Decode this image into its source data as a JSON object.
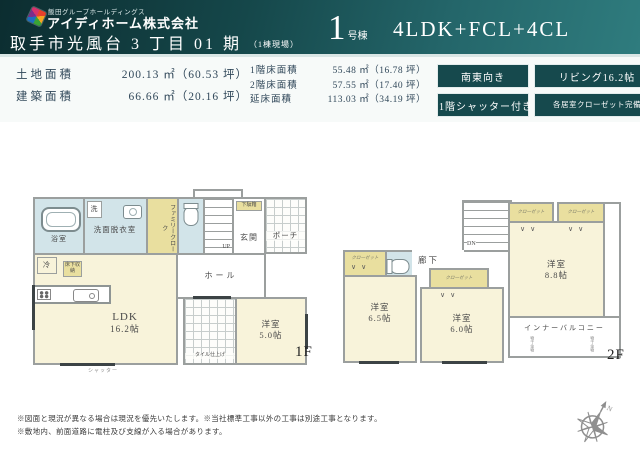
{
  "header": {
    "group_name": "飯田グループホールディングス",
    "company_name": "アイディホーム株式会社",
    "property_title": "取手市光風台 3 丁目 01 期",
    "property_note": "（1棟現場）",
    "unit_number": "1",
    "unit_suffix": "号棟",
    "layout_type": "4LDK+FCL+4CL"
  },
  "areas": {
    "left": [
      {
        "label": "土地面積",
        "value": "200.13 ㎡（60.53 坪）"
      },
      {
        "label": "建築面積",
        "value": "66.66 ㎡（20.16 坪）"
      }
    ],
    "right": [
      {
        "label": "1階床面積",
        "value": "55.48 ㎡（16.78 坪）"
      },
      {
        "label": "2階床面積",
        "value": "57.55 ㎡（17.40 坪）"
      },
      {
        "label": "延床面積",
        "value": "113.03 ㎡（34.19 坪）"
      }
    ]
  },
  "badges": [
    "南東向き",
    "リビング16.2帖",
    "1階シャッター付き",
    "各居室クローゼット完備"
  ],
  "colors": {
    "header_teal_dark": "#0c2d30",
    "header_teal_light": "#2f7c7e",
    "badge_bg": "#16494d",
    "room_tatami": "#f8f3da",
    "room_wet": "#d2e4e9",
    "room_closet": "#e9df9f",
    "wall_gray": "#9b9f9e"
  },
  "floor1": {
    "floor_label": "1F",
    "bath": "浴室",
    "washer": "洗",
    "washroom": "洗面脱衣室",
    "family_cloak": "ファミリークローク",
    "up": "UP",
    "shoe_box": "下駄箱",
    "entrance": "玄関",
    "porch": "ポーチ",
    "hall": "ホール",
    "fridge": "冷",
    "underfloor": "床下収納",
    "ldk": "LDK",
    "ldk_size": "16.2帖",
    "room_name": "洋室",
    "room_size": "5.0帖",
    "tile_note": "タイル仕上げ",
    "shutter_note": "シャッター"
  },
  "floor2": {
    "floor_label": "2F",
    "dn": "DN",
    "hallway": "廊下",
    "closet": "クローゼット",
    "room_a_name": "洋室",
    "room_a_size": "6.5帖",
    "room_b_name": "洋室",
    "room_b_size": "6.0帖",
    "room_c_name": "洋室",
    "room_c_size": "8.8帖",
    "balcony": "インナーバルコニー",
    "hanger_note": "物干金物"
  },
  "footer": {
    "notes": [
      "※図面と現況が異なる場合は現況を優先いたします。※当社標準工事以外の工事は別途工事となります。",
      "※敷地内、前面道路に電柱及び支線が入る場合があります。"
    ],
    "compass_label": "N"
  }
}
